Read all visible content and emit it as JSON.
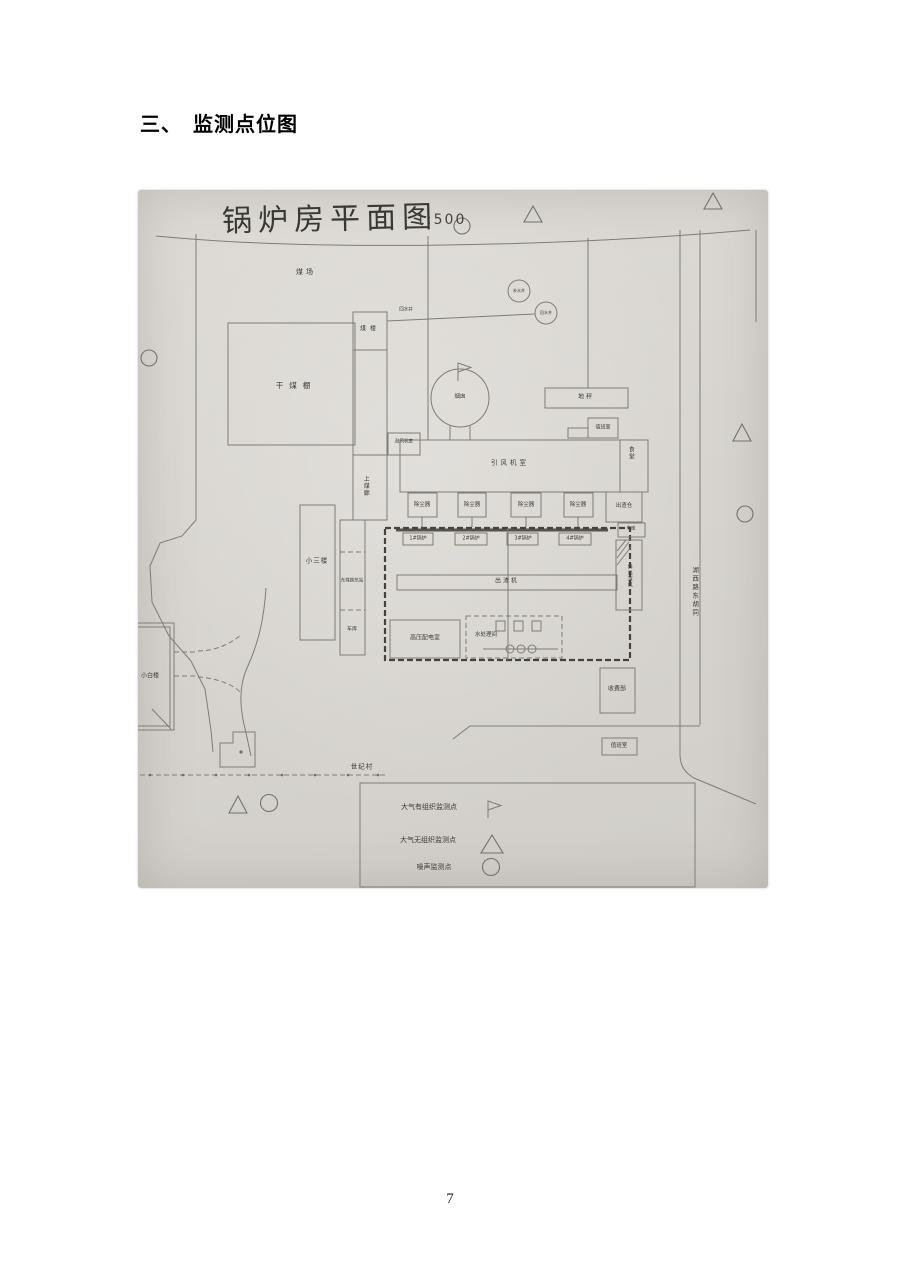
{
  "page": {
    "heading": "三、　监测点位图",
    "page_number": "7"
  },
  "plan": {
    "title": "锅炉房平面图",
    "scale": "1:500",
    "labels": {
      "coal_yard": "煤场",
      "well_top": "补水井",
      "well_right": "回水井",
      "well_line": "回水井",
      "coal_tower": "煤楼",
      "dry_coal_shed": "干煤棚",
      "chimney": "烟囱",
      "weighbridge": "地秤",
      "duty_room_top": "值班室",
      "canteen": "食堂",
      "induced_fan_room": "引风机室",
      "blower_room": "鼓风机室",
      "coal_corridor": "上煤廊",
      "slag_bin": "出渣仓",
      "garage_right": "车库",
      "inclined_slag_machine": "斜出渣机",
      "slag_machine": "出渣机",
      "small_three_storey": "小三楼",
      "east_coal_heat_station": "东煤换热站",
      "garage_left": "车库",
      "hv_distribution_room": "高压配电室",
      "water_treatment_room": "水处理间",
      "toll_office": "收费部",
      "duty_room_bottom": "值班室",
      "century_village": "世纪村",
      "small_white_building": "小白楼",
      "road_name": "湖西路东胡同"
    },
    "dust_collectors": [
      "除尘器",
      "除尘器",
      "除尘器",
      "除尘器"
    ],
    "boilers": [
      "1#锅炉",
      "2#锅炉",
      "3#锅炉",
      "4#锅炉"
    ],
    "legend": [
      {
        "label": "大气有组织监测点",
        "symbol": "flag"
      },
      {
        "label": "大气无组织监测点",
        "symbol": "triangle"
      },
      {
        "label": "噪声监测点",
        "symbol": "circle"
      }
    ]
  }
}
